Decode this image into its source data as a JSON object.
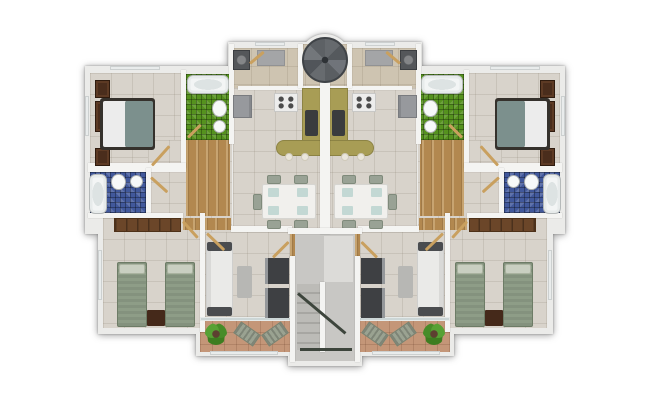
{
  "meta": {
    "description": "Top-down 3D architectural floor plan render of one residential level with two mirrored apartment units around a central stair hall",
    "units": 2,
    "rooms": [
      "master-bedroom",
      "green-bathroom",
      "blue-bathroom",
      "laundry-utility",
      "kitchen",
      "dining-area",
      "living-room",
      "second-bedroom",
      "balcony",
      "stair-hall",
      "spiral-staircase",
      "entry-vestibule"
    ]
  },
  "palette": {
    "page_bg": "#ffffff",
    "wall": "#f4f4f2",
    "shell": "#ebebe9",
    "floor_tile": "#d8d3cb",
    "floor_tan": "#cec4b1",
    "wood": "#b2884f",
    "terracotta": "#c49678",
    "mosaic_green": "#55921e",
    "mosaic_blue": "#41589b",
    "counter_olive": "#a89d55",
    "white": "#ececec",
    "teal": "#7c908d",
    "bedframe": "#35312c",
    "dark": "#4a4c4f",
    "dark2": "#3a3c3e",
    "ltgray": "#b7b7b4",
    "brown2": "#45291a",
    "sage": "#8e9d87",
    "wardrobe_brown": "#4a2d1c",
    "plant_green": "#4e9130",
    "rail": "#3d453c",
    "hallfloor": "#c8c7c4",
    "landing": "#dcdbd8"
  },
  "building": {
    "shell": [
      {
        "n": "wing-top-slab",
        "c": "shell",
        "x": 228,
        "y": 42,
        "w": 194,
        "h": 50
      },
      {
        "n": "stair-bump-slab",
        "c": "shell",
        "x": 299,
        "y": 34,
        "w": 52,
        "h": 52,
        "rad": "50%"
      },
      {
        "n": "upper-band-slab",
        "c": "shell",
        "x": 85,
        "y": 66,
        "w": 480,
        "h": 168
      },
      {
        "n": "lower-band-slab",
        "c": "shell",
        "x": 98,
        "y": 213,
        "w": 455,
        "h": 121
      },
      {
        "n": "balcony-band-slab",
        "c": "shell",
        "x": 196,
        "y": 228,
        "w": 258,
        "h": 128
      },
      {
        "n": "stair-hall-slab",
        "c": "shell",
        "x": 288,
        "y": 228,
        "w": 74,
        "h": 138
      }
    ],
    "shared_floors": [
      {
        "n": "vestibule-floor",
        "c": "tile-tan",
        "x": 303,
        "y": 44,
        "w": 44,
        "h": 44
      },
      {
        "n": "stair-hall-floor",
        "f": "hallfloor",
        "x": 295,
        "y": 233,
        "w": 60,
        "h": 128
      },
      {
        "n": "stair-landing",
        "f": "landing",
        "x": 324,
        "y": 236,
        "w": 29,
        "h": 46
      },
      {
        "n": "stair-treads",
        "c": "treads",
        "x": 297,
        "y": 284,
        "w": 23,
        "h": 66
      }
    ],
    "unit": [
      {
        "n": "master-bedroom-floor",
        "c": "tile",
        "x": 5,
        "y": 37,
        "w": 93,
        "h": 92
      },
      {
        "n": "hall-floor",
        "c": "tile",
        "x": 63,
        "y": 104,
        "w": 84,
        "h": 92
      },
      {
        "n": "kitchen-dining-floor",
        "c": "tile",
        "x": 148,
        "y": 52,
        "w": 89,
        "h": 144
      },
      {
        "n": "laundry-floor",
        "c": "tile-tan",
        "x": 148,
        "y": 12,
        "w": 89,
        "h": 40
      },
      {
        "n": "second-bedroom-floor",
        "c": "tile",
        "x": 18,
        "y": 182,
        "w": 102,
        "h": 110
      },
      {
        "n": "living-room-floor",
        "c": "tile",
        "x": 120,
        "y": 196,
        "w": 87,
        "h": 88
      },
      {
        "n": "balcony-floor",
        "c": "terra",
        "x": 115,
        "y": 284,
        "w": 92,
        "h": 32
      },
      {
        "n": "blue-bathroom-floor",
        "c": "mos-blue",
        "x": 5,
        "y": 136,
        "w": 58,
        "h": 43
      },
      {
        "n": "green-bathroom-floor",
        "c": "mos-green",
        "x": 101,
        "y": 38,
        "w": 44,
        "h": 66
      },
      {
        "n": "corridor-wood-floor",
        "c": "wood",
        "x": 101,
        "y": 104,
        "w": 44,
        "h": 76
      },
      {
        "n": "doorway-threshold",
        "c": "wood",
        "x": 98,
        "y": 182,
        "w": 22,
        "h": 12
      },
      {
        "n": "doorway-threshold",
        "c": "wood",
        "x": 120,
        "y": 182,
        "w": 26,
        "h": 12
      },
      {
        "n": "wall",
        "c": "wall",
        "x": 96,
        "y": 34,
        "w": 5,
        "h": 98
      },
      {
        "n": "wall",
        "c": "wall",
        "x": 3,
        "y": 127,
        "w": 98,
        "h": 9
      },
      {
        "n": "wall",
        "c": "wall",
        "x": 144,
        "y": 8,
        "w": 5,
        "h": 100
      },
      {
        "n": "wall",
        "c": "wall",
        "x": 153,
        "y": 50,
        "w": 84,
        "h": 4
      },
      {
        "n": "wall",
        "c": "wall",
        "x": 61,
        "y": 132,
        "w": 5,
        "h": 50
      },
      {
        "n": "wall",
        "c": "wall",
        "x": 3,
        "y": 177,
        "w": 95,
        "h": 5
      },
      {
        "n": "wall",
        "c": "wall",
        "x": 115,
        "y": 177,
        "w": 5,
        "h": 119
      },
      {
        "n": "wall",
        "c": "wall",
        "x": 146,
        "y": 190,
        "w": 61,
        "h": 6
      },
      {
        "n": "wall",
        "c": "wall",
        "x": 213,
        "y": 8,
        "w": 5,
        "h": 44
      },
      {
        "n": "balcony-sliding-door",
        "c": "glass",
        "x": 115,
        "y": 281,
        "w": 92,
        "h": 4
      },
      {
        "n": "window",
        "c": "win",
        "x": 0,
        "y": 60,
        "w": 4,
        "h": 40
      },
      {
        "n": "window",
        "c": "win",
        "x": 13,
        "y": 214,
        "w": 4,
        "h": 50
      },
      {
        "n": "window",
        "c": "win",
        "x": 170,
        "y": 6,
        "w": 30,
        "h": 4
      },
      {
        "n": "window",
        "c": "win",
        "x": 25,
        "y": 30,
        "w": 50,
        "h": 4
      },
      {
        "n": "window",
        "c": "win",
        "x": 125,
        "y": 315,
        "w": 68,
        "h": 4
      },
      {
        "n": "wardrobe",
        "c": "dresser",
        "x": 10,
        "y": 44,
        "w": 15,
        "h": 18
      },
      {
        "n": "wardrobe",
        "c": "dresser",
        "x": 10,
        "y": 65,
        "w": 15,
        "h": 31
      },
      {
        "n": "wardrobe",
        "c": "dresser",
        "x": 10,
        "y": 112,
        "w": 15,
        "h": 18
      },
      {
        "n": "double-bed-frame",
        "f": "bedframe",
        "x": 15,
        "y": 62,
        "w": 55,
        "h": 52,
        "rad": 3
      },
      {
        "n": "bed-sheet",
        "f": "white",
        "x": 18,
        "y": 65,
        "w": 24,
        "h": 46,
        "rad": 2
      },
      {
        "n": "bed-blanket",
        "f": "teal",
        "x": 40,
        "y": 65,
        "w": 28,
        "h": 46,
        "rad": 2
      },
      {
        "n": "bathtub",
        "c": "tub",
        "x": 102,
        "y": 39,
        "w": 42,
        "h": 19
      },
      {
        "n": "toilet",
        "c": "wc",
        "x": 127,
        "y": 64,
        "w": 15,
        "h": 17
      },
      {
        "n": "washbasin",
        "c": "sink",
        "x": 128,
        "y": 84,
        "w": 13,
        "h": 13
      },
      {
        "n": "bathtub",
        "c": "tub",
        "x": 4,
        "y": 138,
        "w": 18,
        "h": 40
      },
      {
        "n": "toilet",
        "c": "wc",
        "x": 26,
        "y": 138,
        "w": 15,
        "h": 16
      },
      {
        "n": "washbasin",
        "c": "sink",
        "x": 45,
        "y": 139,
        "w": 13,
        "h": 13
      },
      {
        "n": "washing-machine",
        "c": "appl",
        "x": 148,
        "y": 14,
        "w": 17,
        "h": 20
      },
      {
        "n": "doormat",
        "c": "rug",
        "x": 172,
        "y": 14,
        "w": 28,
        "h": 16
      },
      {
        "n": "fridge",
        "c": "fridge",
        "x": 148,
        "y": 59,
        "w": 19,
        "h": 23
      },
      {
        "n": "stove",
        "c": "stove",
        "x": 189,
        "y": 57,
        "w": 24,
        "h": 19
      },
      {
        "n": "kitchen-counter",
        "c": "counter",
        "x": 217,
        "y": 52,
        "w": 20,
        "h": 60
      },
      {
        "n": "kitchen-bar",
        "c": "counter",
        "x": 191,
        "y": 104,
        "w": 46,
        "h": 16,
        "rad": "8px 0 0 8px"
      },
      {
        "n": "kitchen-sink",
        "f": "dark2",
        "x": 220,
        "y": 74,
        "w": 13,
        "h": 26,
        "rad": 2
      },
      {
        "n": "bar-stool",
        "c": "stool",
        "x": 200,
        "y": 117,
        "w": 8,
        "h": 8
      },
      {
        "n": "bar-stool",
        "c": "stool",
        "x": 216,
        "y": 117,
        "w": 8,
        "h": 8
      },
      {
        "n": "dining-table",
        "c": "table",
        "x": 177,
        "y": 148,
        "w": 54,
        "h": 35
      },
      {
        "n": "placemat",
        "c": "mat",
        "x": 183,
        "y": 152,
        "w": 11,
        "h": 9
      },
      {
        "n": "placemat",
        "c": "mat",
        "x": 212,
        "y": 152,
        "w": 11,
        "h": 9
      },
      {
        "n": "placemat",
        "c": "mat",
        "x": 183,
        "y": 170,
        "w": 11,
        "h": 9
      },
      {
        "n": "placemat",
        "c": "mat",
        "x": 212,
        "y": 170,
        "w": 11,
        "h": 9
      },
      {
        "n": "dining-chair",
        "c": "chair",
        "x": 182,
        "y": 139,
        "w": 14,
        "h": 9
      },
      {
        "n": "dining-chair",
        "c": "chair",
        "x": 209,
        "y": 139,
        "w": 14,
        "h": 9
      },
      {
        "n": "dining-chair",
        "c": "chair",
        "x": 182,
        "y": 184,
        "w": 14,
        "h": 9
      },
      {
        "n": "dining-chair",
        "c": "chair",
        "x": 209,
        "y": 184,
        "w": 14,
        "h": 9
      },
      {
        "n": "dining-chair",
        "c": "chair",
        "x": 168,
        "y": 158,
        "w": 9,
        "h": 16
      },
      {
        "n": "sofa",
        "c": "sofa",
        "x": 121,
        "y": 206,
        "w": 27,
        "h": 74
      },
      {
        "n": "sofa-armrest",
        "f": "dark",
        "x": 122,
        "y": 206,
        "w": 25,
        "h": 9,
        "rad": 2
      },
      {
        "n": "sofa-armrest",
        "f": "dark",
        "x": 122,
        "y": 271,
        "w": 25,
        "h": 9,
        "rad": 2
      },
      {
        "n": "coffee-table",
        "f": "ltgray",
        "x": 152,
        "y": 230,
        "w": 15,
        "h": 32,
        "rad": 2
      },
      {
        "n": "tv-cabinet",
        "c": "tv",
        "x": 180,
        "y": 222,
        "w": 24,
        "h": 26
      },
      {
        "n": "tv-cabinet",
        "c": "tv",
        "x": 180,
        "y": 252,
        "w": 24,
        "h": 30
      },
      {
        "n": "closet",
        "c": "closet",
        "x": 29,
        "y": 182,
        "w": 67,
        "h": 14
      },
      {
        "n": "single-bed",
        "c": "sbed",
        "x": 32,
        "y": 226,
        "w": 30,
        "h": 65
      },
      {
        "n": "bed-pillow",
        "c": "pillow",
        "x": 34,
        "y": 228,
        "w": 26,
        "h": 10
      },
      {
        "n": "single-bed",
        "c": "sbed",
        "x": 80,
        "y": 226,
        "w": 30,
        "h": 65
      },
      {
        "n": "bed-pillow",
        "c": "pillow",
        "x": 82,
        "y": 228,
        "w": 26,
        "h": 10
      },
      {
        "n": "nightstand",
        "f": "brown2",
        "x": 62,
        "y": 274,
        "w": 18,
        "h": 16,
        "rad": 1
      },
      {
        "n": "potted-plant",
        "c": "plant",
        "x": 120,
        "y": 287,
        "w": 22,
        "h": 22
      },
      {
        "n": "lounge-chair",
        "c": "lounge",
        "x": 150,
        "y": 291,
        "w": 24,
        "h": 14,
        "rot": 35
      },
      {
        "n": "lounge-chair",
        "c": "lounge",
        "x": 178,
        "y": 291,
        "w": 24,
        "h": 14,
        "rot": -35
      },
      {
        "n": "door-swing",
        "c": "swing",
        "x": 67,
        "y": 128,
        "w": 26,
        "h": 3,
        "rot": -48
      },
      {
        "n": "door-swing",
        "c": "swing",
        "x": 66,
        "y": 140,
        "w": 22,
        "h": 3,
        "rot": 42
      },
      {
        "n": "door-swing",
        "c": "swing",
        "x": 98,
        "y": 184,
        "w": 22,
        "h": 3,
        "rot": 48
      },
      {
        "n": "door-swing",
        "c": "swing",
        "x": 122,
        "y": 196,
        "w": 24,
        "h": 3,
        "rot": 44
      },
      {
        "n": "door-swing",
        "c": "swing",
        "x": 188,
        "y": 220,
        "w": 22,
        "h": 3,
        "rot": -45
      },
      {
        "n": "door-swing",
        "c": "swing",
        "x": 165,
        "y": 26,
        "w": 18,
        "h": 3,
        "rot": -40
      },
      {
        "n": "door-swing",
        "c": "swing",
        "x": 103,
        "y": 100,
        "w": 18,
        "h": 3,
        "rot": -45
      }
    ],
    "shared_top": [
      {
        "n": "central-party-wall",
        "c": "wall",
        "x": 320,
        "y": 58,
        "w": 10,
        "h": 176
      },
      {
        "n": "hall-top-wall",
        "c": "wall",
        "x": 288,
        "y": 228,
        "w": 74,
        "h": 6
      },
      {
        "n": "hall-doorway-threshold",
        "c": "wood",
        "x": 290,
        "y": 234,
        "w": 5,
        "h": 22
      },
      {
        "n": "hall-doorway-threshold",
        "c": "wood",
        "x": 355,
        "y": 234,
        "w": 5,
        "h": 22
      },
      {
        "n": "hall-side-wall",
        "c": "wall",
        "x": 290,
        "y": 256,
        "w": 5,
        "h": 106
      },
      {
        "n": "hall-side-wall",
        "c": "wall",
        "x": 355,
        "y": 256,
        "w": 5,
        "h": 106
      },
      {
        "n": "stair-flight-wall",
        "c": "wall",
        "x": 320,
        "y": 282,
        "w": 5,
        "h": 70
      },
      {
        "n": "stair-handrail",
        "f": "rail",
        "c": "rail",
        "x": 298,
        "y": 292,
        "w": 62,
        "h": 3,
        "rot": 40
      },
      {
        "n": "stair-handrail",
        "f": "rail",
        "x": 300,
        "y": 348,
        "w": 52,
        "h": 3
      },
      {
        "n": "spiral-staircase",
        "c": "spiral",
        "x": 302,
        "y": 37,
        "w": 46,
        "h": 46
      }
    ]
  }
}
